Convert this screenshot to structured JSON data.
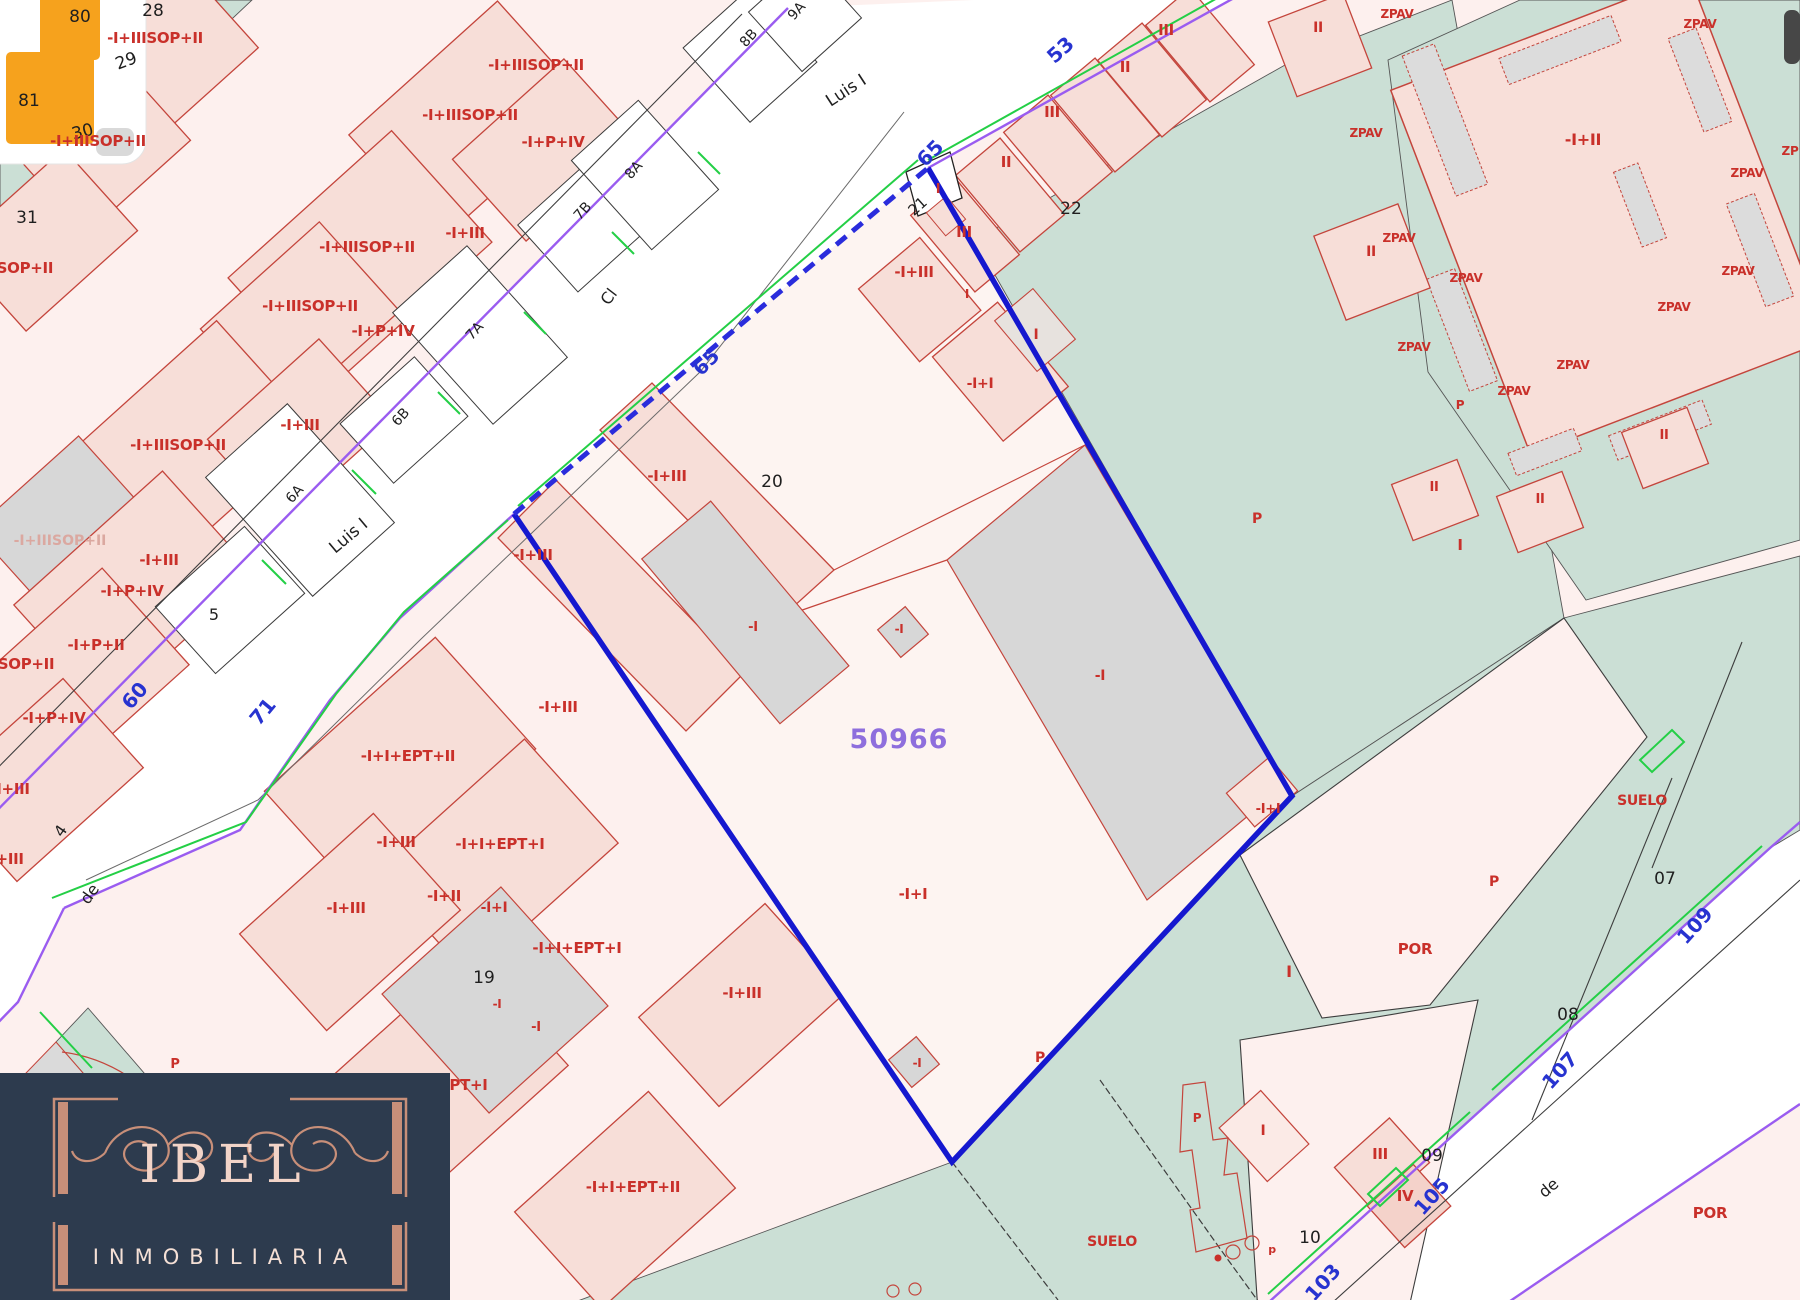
{
  "map": {
    "parcel": {
      "reference": "50966",
      "parcel_number": "20",
      "neighbor_parcel": "22"
    },
    "streets": [
      "Luis I",
      "Cl",
      "de"
    ],
    "street_numbers": [
      "53",
      "60",
      "65",
      "71",
      "103",
      "105",
      "107",
      "109"
    ],
    "zone_labels": [
      "SUELO",
      "POR",
      "ZPAV",
      "P"
    ],
    "colors": {
      "parcel_outline_blue": "#1518cf",
      "street_edge_purple": "#9a5cf0",
      "curb_green": "#24cf46",
      "cadastre_red": "#c9302a",
      "teal_zone": "#cbdfd5",
      "building_grey": "#d7d7d7",
      "reference_purple": "#8e6edd",
      "watermark_navy": "#2d3b4e",
      "watermark_copper": "#c88f79"
    },
    "labels": [
      {
        "t": "80",
        "x": 80,
        "y": 22,
        "c": "k",
        "s": 17
      },
      {
        "t": "28",
        "x": 153,
        "y": 16,
        "c": "k",
        "s": 17
      },
      {
        "t": "29",
        "x": 128,
        "y": 66,
        "c": "k",
        "s": 17,
        "r": -20
      },
      {
        "t": "81",
        "x": 29,
        "y": 106,
        "c": "k",
        "s": 17
      },
      {
        "t": "30",
        "x": 84,
        "y": 137,
        "c": "k",
        "s": 17,
        "r": -15
      },
      {
        "t": "31",
        "x": 27,
        "y": 223,
        "c": "k",
        "s": 17
      },
      {
        "t": "5",
        "x": 214,
        "y": 620,
        "c": "k",
        "s": 16
      },
      {
        "t": "4",
        "x": 65,
        "y": 834,
        "c": "k",
        "s": 16,
        "r": -55
      },
      {
        "t": "de",
        "x": 94,
        "y": 897,
        "c": "k",
        "s": 16,
        "r": -55
      },
      {
        "t": "6A",
        "x": 298,
        "y": 497,
        "c": "k",
        "s": 14,
        "r": -48
      },
      {
        "t": "6B",
        "x": 404,
        "y": 420,
        "c": "k",
        "s": 14,
        "r": -48
      },
      {
        "t": "7A",
        "x": 478,
        "y": 334,
        "c": "k",
        "s": 14,
        "r": -48
      },
      {
        "t": "7B",
        "x": 586,
        "y": 214,
        "c": "k",
        "s": 14,
        "r": -48
      },
      {
        "t": "8A",
        "x": 637,
        "y": 173,
        "c": "k",
        "s": 14,
        "r": -48
      },
      {
        "t": "8B",
        "x": 752,
        "y": 41,
        "c": "k",
        "s": 14,
        "r": -48
      },
      {
        "t": "9A",
        "x": 800,
        "y": 14,
        "c": "k",
        "s": 14,
        "r": -48
      },
      {
        "t": "Luis I",
        "x": 849,
        "y": 95,
        "c": "k",
        "s": 17,
        "r": -33
      },
      {
        "t": "Cl",
        "x": 613,
        "y": 300,
        "c": "k",
        "s": 16,
        "r": -52
      },
      {
        "t": "Luis I",
        "x": 352,
        "y": 540,
        "c": "k",
        "s": 17,
        "r": -40
      },
      {
        "t": "20",
        "x": 772,
        "y": 487,
        "c": "k",
        "s": 17
      },
      {
        "t": "21",
        "x": 921,
        "y": 210,
        "c": "k",
        "s": 15,
        "r": -42
      },
      {
        "t": "22",
        "x": 1071,
        "y": 214,
        "c": "k",
        "s": 17
      },
      {
        "t": "19",
        "x": 484,
        "y": 983,
        "c": "k",
        "s": 17
      },
      {
        "t": "10",
        "x": 1310,
        "y": 1243,
        "c": "k",
        "s": 17
      },
      {
        "t": "07",
        "x": 1665,
        "y": 884,
        "c": "k",
        "s": 17
      },
      {
        "t": "08",
        "x": 1568,
        "y": 1020,
        "c": "k",
        "s": 17
      },
      {
        "t": "09",
        "x": 1432,
        "y": 1161,
        "c": "k",
        "s": 17
      },
      {
        "t": "de",
        "x": 1552,
        "y": 1192,
        "c": "k",
        "s": 16,
        "r": -40
      },
      {
        "t": "60",
        "x": 140,
        "y": 700,
        "c": "b",
        "s": 20,
        "r": -50
      },
      {
        "t": "71",
        "x": 268,
        "y": 716,
        "c": "b",
        "s": 20,
        "r": -50
      },
      {
        "t": "65",
        "x": 935,
        "y": 158,
        "c": "b",
        "s": 20,
        "r": -45
      },
      {
        "t": "65",
        "x": 711,
        "y": 367,
        "c": "b",
        "s": 20,
        "r": -45
      },
      {
        "t": "53",
        "x": 1065,
        "y": 55,
        "c": "b",
        "s": 20,
        "r": -42
      },
      {
        "t": "103",
        "x": 1328,
        "y": 1287,
        "c": "b",
        "s": 20,
        "r": -48
      },
      {
        "t": "105",
        "x": 1437,
        "y": 1201,
        "c": "b",
        "s": 20,
        "r": -48
      },
      {
        "t": "107",
        "x": 1565,
        "y": 1075,
        "c": "b",
        "s": 20,
        "r": -48
      },
      {
        "t": "109",
        "x": 1700,
        "y": 930,
        "c": "b",
        "s": 20,
        "r": -48
      },
      {
        "t": "50966",
        "x": 899,
        "y": 748,
        "c": "v",
        "s": 27
      },
      {
        "t": "-I+IIISOP+II",
        "x": 155,
        "y": 43,
        "c": "r",
        "s": 15
      },
      {
        "t": "-I+IIISOP+II",
        "x": 536,
        "y": 70,
        "c": "r",
        "s": 15
      },
      {
        "t": "-I+IIISOP+II",
        "x": 470,
        "y": 120,
        "c": "r",
        "s": 15
      },
      {
        "t": "-I+P+IV",
        "x": 553,
        "y": 147,
        "c": "r",
        "s": 15
      },
      {
        "t": "-I+IIISOP+II",
        "x": 98,
        "y": 146,
        "c": "r",
        "s": 15
      },
      {
        "t": "-I+IIISOP+II",
        "x": 367,
        "y": 252,
        "c": "r",
        "s": 15
      },
      {
        "t": "-I+III",
        "x": 465,
        "y": 238,
        "c": "r",
        "s": 15
      },
      {
        "t": "-IIISOP+II",
        "x": 14,
        "y": 273,
        "c": "r",
        "s": 15
      },
      {
        "t": "-I+IIISOP+II",
        "x": 310,
        "y": 311,
        "c": "r",
        "s": 15
      },
      {
        "t": "-I+P+IV",
        "x": 383,
        "y": 336,
        "c": "r",
        "s": 15
      },
      {
        "t": "-I+III",
        "x": 300,
        "y": 430,
        "c": "r",
        "s": 15
      },
      {
        "t": "-I+IIISOP+II",
        "x": 178,
        "y": 450,
        "c": "r",
        "s": 15
      },
      {
        "t": "-I+IIISOP+II",
        "x": 60,
        "y": 545,
        "c": "rf",
        "s": 14
      },
      {
        "t": "-I+III",
        "x": 159,
        "y": 565,
        "c": "r",
        "s": 15
      },
      {
        "t": "-I+P+IV",
        "x": 132,
        "y": 596,
        "c": "r",
        "s": 15
      },
      {
        "t": "-I+P+II",
        "x": 96,
        "y": 650,
        "c": "r",
        "s": 15
      },
      {
        "t": "SOP+II",
        "x": 26,
        "y": 669,
        "c": "r",
        "s": 15
      },
      {
        "t": "-I+P+IV",
        "x": 54,
        "y": 723,
        "c": "r",
        "s": 15
      },
      {
        "t": "-I+III",
        "x": 10,
        "y": 794,
        "c": "r",
        "s": 15
      },
      {
        "t": "-I+III",
        "x": 4,
        "y": 864,
        "c": "r",
        "s": 15
      },
      {
        "t": "-I+III",
        "x": 914,
        "y": 277,
        "c": "r",
        "s": 15
      },
      {
        "t": "-I+I",
        "x": 980,
        "y": 388,
        "c": "r",
        "s": 14
      },
      {
        "t": "-I+III",
        "x": 667,
        "y": 481,
        "c": "r",
        "s": 15
      },
      {
        "t": "-I+III",
        "x": 533,
        "y": 560,
        "c": "r",
        "s": 15
      },
      {
        "t": "-I+III",
        "x": 558,
        "y": 712,
        "c": "r",
        "s": 15
      },
      {
        "t": "-I",
        "x": 753,
        "y": 631,
        "c": "r",
        "s": 13
      },
      {
        "t": "-I",
        "x": 899,
        "y": 633,
        "c": "r",
        "s": 12
      },
      {
        "t": "-I",
        "x": 1100,
        "y": 680,
        "c": "r",
        "s": 14
      },
      {
        "t": "-I+I",
        "x": 913,
        "y": 899,
        "c": "r",
        "s": 15
      },
      {
        "t": "-I+I",
        "x": 1268,
        "y": 813,
        "c": "r",
        "s": 13
      },
      {
        "t": "-I",
        "x": 917,
        "y": 1067,
        "c": "r",
        "s": 12
      },
      {
        "t": "-I+I+EPT+II",
        "x": 408,
        "y": 761,
        "c": "r",
        "s": 15
      },
      {
        "t": "-I+III",
        "x": 396,
        "y": 847,
        "c": "r",
        "s": 15
      },
      {
        "t": "-I+I+EPT+I",
        "x": 500,
        "y": 849,
        "c": "r",
        "s": 15
      },
      {
        "t": "-I+II",
        "x": 444,
        "y": 901,
        "c": "r",
        "s": 15
      },
      {
        "t": "-I+III",
        "x": 346,
        "y": 913,
        "c": "r",
        "s": 15
      },
      {
        "t": "-I+I",
        "x": 494,
        "y": 912,
        "c": "r",
        "s": 14
      },
      {
        "t": "-I+I+EPT+I",
        "x": 577,
        "y": 953,
        "c": "r",
        "s": 15
      },
      {
        "t": "-I",
        "x": 497,
        "y": 1008,
        "c": "r",
        "s": 12
      },
      {
        "t": "-I",
        "x": 536,
        "y": 1031,
        "c": "r",
        "s": 13
      },
      {
        "t": "-I+I+EPT+I",
        "x": 443,
        "y": 1090,
        "c": "r",
        "s": 15
      },
      {
        "t": "-I+I+EPT+II",
        "x": 633,
        "y": 1192,
        "c": "r",
        "s": 15
      },
      {
        "t": "-I+III",
        "x": 742,
        "y": 998,
        "c": "r",
        "s": 15
      },
      {
        "t": "-I+II",
        "x": 1583,
        "y": 145,
        "c": "r",
        "s": 16
      },
      {
        "t": "SUELO",
        "x": 1642,
        "y": 805,
        "c": "r",
        "s": 14
      },
      {
        "t": "SUELO",
        "x": 1112,
        "y": 1246,
        "c": "r",
        "s": 14
      },
      {
        "t": "POR",
        "x": 1415,
        "y": 954,
        "c": "r",
        "s": 15
      },
      {
        "t": "POR",
        "x": 1710,
        "y": 1218,
        "c": "r",
        "s": 15
      },
      {
        "t": "P",
        "x": 1257,
        "y": 523,
        "c": "r",
        "s": 14
      },
      {
        "t": "P",
        "x": 1494,
        "y": 886,
        "c": "r",
        "s": 14
      },
      {
        "t": "P",
        "x": 1040,
        "y": 1062,
        "c": "r",
        "s": 14
      },
      {
        "t": "P",
        "x": 175,
        "y": 1068,
        "c": "r",
        "s": 13
      },
      {
        "t": "P",
        "x": 1460,
        "y": 409,
        "c": "r",
        "s": 12
      },
      {
        "t": "P",
        "x": 1197,
        "y": 1122,
        "c": "r",
        "s": 12
      },
      {
        "t": "p",
        "x": 1272,
        "y": 1253,
        "c": "r",
        "s": 11
      },
      {
        "t": "III",
        "x": 1166,
        "y": 35,
        "c": "r",
        "s": 15
      },
      {
        "t": "II",
        "x": 1125,
        "y": 72,
        "c": "r",
        "s": 15
      },
      {
        "t": "III",
        "x": 1052,
        "y": 117,
        "c": "r",
        "s": 15
      },
      {
        "t": "II",
        "x": 1006,
        "y": 167,
        "c": "r",
        "s": 15
      },
      {
        "t": "I",
        "x": 938,
        "y": 193,
        "c": "r",
        "s": 13
      },
      {
        "t": "III",
        "x": 964,
        "y": 237,
        "c": "r",
        "s": 15
      },
      {
        "t": "I",
        "x": 1036,
        "y": 339,
        "c": "r",
        "s": 14
      },
      {
        "t": "I",
        "x": 967,
        "y": 298,
        "c": "r",
        "s": 12
      },
      {
        "t": "II",
        "x": 1318,
        "y": 32,
        "c": "r",
        "s": 14
      },
      {
        "t": "II",
        "x": 1371,
        "y": 256,
        "c": "r",
        "s": 14
      },
      {
        "t": "II",
        "x": 1434,
        "y": 491,
        "c": "r",
        "s": 13
      },
      {
        "t": "II",
        "x": 1540,
        "y": 503,
        "c": "r",
        "s": 13
      },
      {
        "t": "II",
        "x": 1664,
        "y": 439,
        "c": "r",
        "s": 13
      },
      {
        "t": "I",
        "x": 1460,
        "y": 550,
        "c": "r",
        "s": 15
      },
      {
        "t": "I",
        "x": 1289,
        "y": 977,
        "c": "r",
        "s": 16
      },
      {
        "t": "I",
        "x": 1263,
        "y": 1135,
        "c": "r",
        "s": 14
      },
      {
        "t": "III",
        "x": 1380,
        "y": 1159,
        "c": "r",
        "s": 15
      },
      {
        "t": "IV",
        "x": 1405,
        "y": 1201,
        "c": "r",
        "s": 15
      },
      {
        "t": "ZPAV",
        "x": 1397,
        "y": 18,
        "c": "r",
        "s": 12
      },
      {
        "t": "ZPAV",
        "x": 1700,
        "y": 28,
        "c": "r",
        "s": 12
      },
      {
        "t": "ZPAV",
        "x": 1366,
        "y": 137,
        "c": "r",
        "s": 12
      },
      {
        "t": "ZPAV",
        "x": 1747,
        "y": 177,
        "c": "r",
        "s": 12
      },
      {
        "t": "ZPAV",
        "x": 1399,
        "y": 242,
        "c": "r",
        "s": 12
      },
      {
        "t": "ZPAV",
        "x": 1466,
        "y": 282,
        "c": "r",
        "s": 12
      },
      {
        "t": "ZPAV",
        "x": 1674,
        "y": 311,
        "c": "r",
        "s": 12
      },
      {
        "t": "ZPAV",
        "x": 1414,
        "y": 351,
        "c": "r",
        "s": 12
      },
      {
        "t": "ZPAV",
        "x": 1573,
        "y": 369,
        "c": "r",
        "s": 12
      },
      {
        "t": "ZPAV",
        "x": 1514,
        "y": 395,
        "c": "r",
        "s": 12
      },
      {
        "t": "ZPAV",
        "x": 1738,
        "y": 275,
        "c": "r",
        "s": 12
      },
      {
        "t": "ZP",
        "x": 1790,
        "y": 155,
        "c": "r",
        "s": 12
      }
    ]
  },
  "watermark": {
    "brand": "IBEL",
    "subtitle": "INMOBILIARIA"
  }
}
